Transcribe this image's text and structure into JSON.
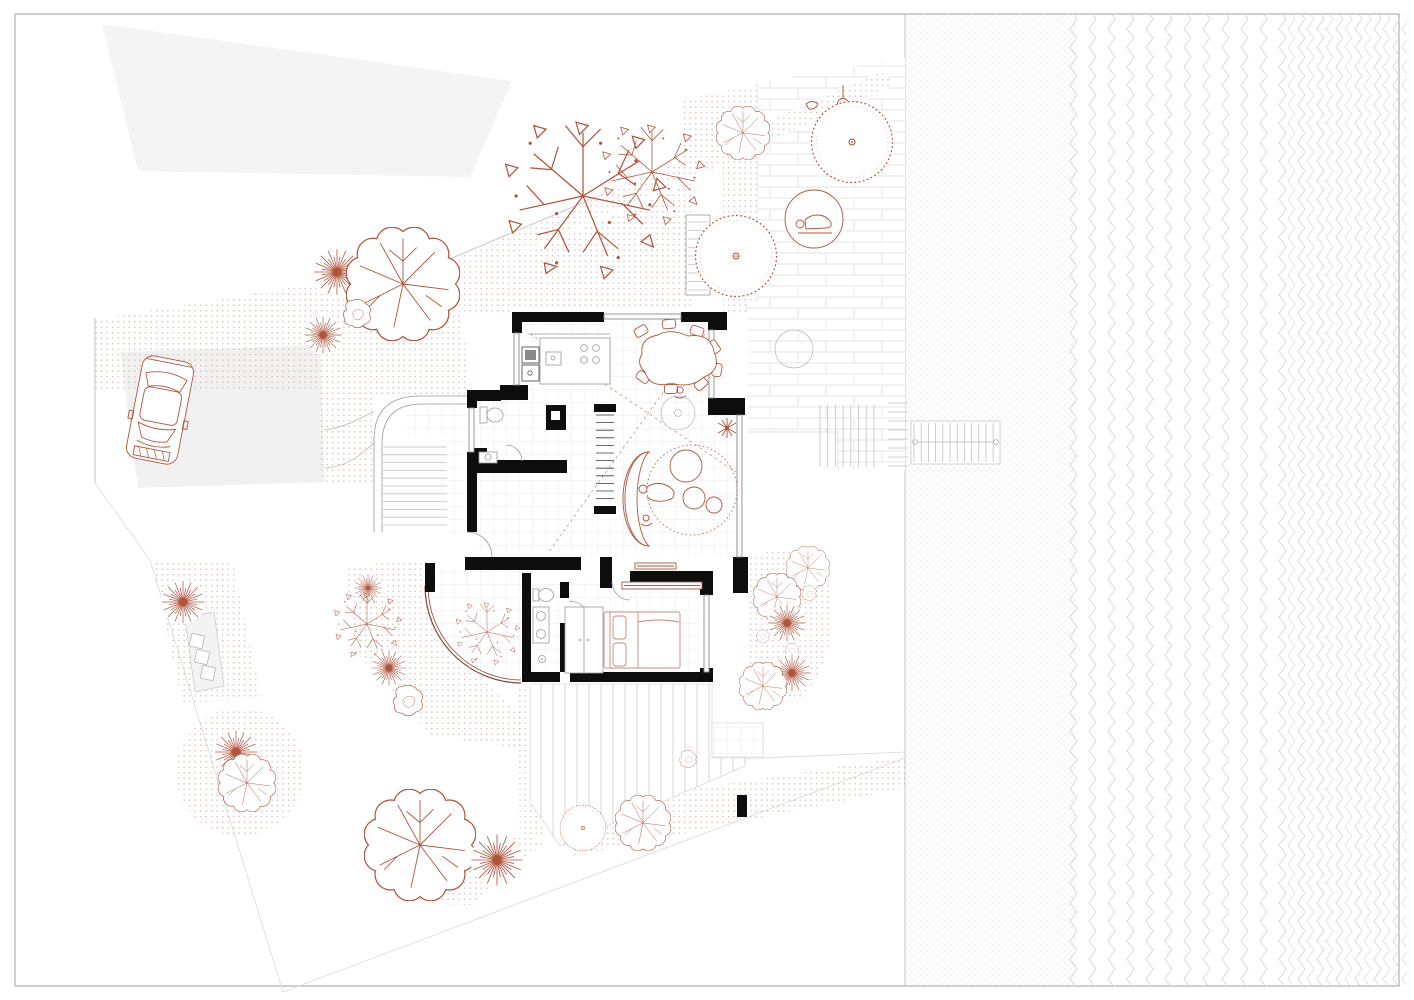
{
  "meta": {
    "title": "Ground floor site plan — house with garden, terraces and waterfront",
    "drawing_type": "architectural-site-plan",
    "visible_text": []
  },
  "palette": {
    "red": "#b0543c",
    "red_light": "#c98877",
    "ink": "#0d0d0d",
    "line_gray": "#9a9a9a",
    "boundary_gray": "#c6c6c6",
    "pale_fill": "#f3f3f3",
    "dot_color": "#d4b0a6",
    "texture_gray": "#dadada",
    "paper": "#ffffff"
  },
  "site": {
    "boundary": {
      "top_diagonal": "888,74 452,258",
      "east_vertical": "905,15 905,985",
      "west_vertical": "95,318 95,483",
      "southwest_diagonal": "95,483 150,560 283,992",
      "south_diagonal": "283,992 905,758"
    },
    "car": {
      "x": 160,
      "y": 410,
      "rotation": 11
    },
    "stepping_stones": [
      {
        "x": 197,
        "y": 641,
        "a": 12
      },
      {
        "x": 202,
        "y": 657,
        "a": 12
      },
      {
        "x": 208,
        "y": 673,
        "a": 12
      }
    ],
    "trees": [
      {
        "type": "branchy",
        "x": 583,
        "y": 196,
        "r": 88
      },
      {
        "type": "branchy",
        "x": 652,
        "y": 172,
        "r": 56
      },
      {
        "type": "dandelion",
        "x": 337,
        "y": 272,
        "r": 26
      },
      {
        "type": "lobed",
        "x": 403,
        "y": 284,
        "r": 57
      },
      {
        "type": "swirl",
        "x": 357,
        "y": 315,
        "r": 26
      },
      {
        "type": "dandelion",
        "x": 323,
        "y": 335,
        "r": 21
      },
      {
        "type": "lobed",
        "x": 743,
        "y": 133,
        "r": 27
      },
      {
        "type": "swirl",
        "x": 858,
        "y": 120,
        "r": 17
      },
      {
        "type": "formal",
        "x": 852,
        "y": 142,
        "r": 46
      },
      {
        "type": "formal",
        "x": 736,
        "y": 256,
        "r": 46
      },
      {
        "type": "dandelion",
        "x": 183,
        "y": 602,
        "r": 24
      },
      {
        "type": "dandelion",
        "x": 368,
        "y": 588,
        "r": 16
      },
      {
        "type": "branchy",
        "x": 367,
        "y": 624,
        "r": 37
      },
      {
        "type": "dandelion",
        "x": 389,
        "y": 668,
        "r": 20
      },
      {
        "type": "swirl",
        "x": 408,
        "y": 702,
        "r": 28
      },
      {
        "type": "branchy",
        "x": 487,
        "y": 632,
        "r": 35
      },
      {
        "type": "lobed",
        "x": 808,
        "y": 568,
        "r": 22
      },
      {
        "type": "lobed",
        "x": 777,
        "y": 597,
        "r": 24
      },
      {
        "type": "swirl",
        "x": 809,
        "y": 594,
        "r": 14
      },
      {
        "type": "dandelion",
        "x": 787,
        "y": 623,
        "r": 21
      },
      {
        "type": "swirl",
        "x": 763,
        "y": 637,
        "r": 12
      },
      {
        "type": "swirl",
        "x": 792,
        "y": 651,
        "r": 13
      },
      {
        "type": "dandelion",
        "x": 792,
        "y": 673,
        "r": 21
      },
      {
        "type": "lobed",
        "x": 763,
        "y": 686,
        "r": 24
      },
      {
        "type": "swirl",
        "x": 688,
        "y": 760,
        "r": 16
      },
      {
        "type": "dandelion",
        "x": 236,
        "y": 752,
        "r": 24
      },
      {
        "type": "lobed",
        "x": 247,
        "y": 783,
        "r": 29
      },
      {
        "type": "lobed",
        "x": 420,
        "y": 845,
        "r": 56
      },
      {
        "type": "dandelion",
        "x": 497,
        "y": 860,
        "r": 29
      },
      {
        "type": "formal",
        "x": 583,
        "y": 828,
        "r": 26
      },
      {
        "type": "lobed",
        "x": 643,
        "y": 823,
        "r": 28
      }
    ],
    "stairs": [
      {
        "name": "entry-stair",
        "dir": "h",
        "x": 383,
        "y": 447,
        "w": 64,
        "n": 11,
        "step": 7.8
      },
      {
        "name": "main-interior-stair",
        "dir": "h",
        "x": 596,
        "y": 415,
        "w": 18,
        "n": 12,
        "step": 7.6,
        "dark": true
      },
      {
        "name": "upper-terrace-stair",
        "dir": "h",
        "x": 688,
        "y": 222,
        "w": 20,
        "n": 9,
        "step": 8.5
      },
      {
        "name": "terrace-steps",
        "dir": "v",
        "x": 820,
        "y": 405,
        "h": 62,
        "n": 8,
        "step": 7.7
      },
      {
        "name": "boundary-steps",
        "dir": "h",
        "x": 888,
        "y": 403,
        "w": 20,
        "n": 8,
        "step": 9
      },
      {
        "name": "footbridge-planks",
        "dir": "v",
        "x": 914,
        "y": 423,
        "h": 39,
        "n": 12,
        "step": 7.2
      }
    ],
    "rooms": [
      "entry",
      "hall",
      "wc",
      "kitchen",
      "dining-area",
      "living-area",
      "main-stair",
      "bathroom",
      "bedroom",
      "courtyard",
      "east-terrace",
      "upper-terrace",
      "south-deck",
      "driveway",
      "waterfront"
    ]
  }
}
